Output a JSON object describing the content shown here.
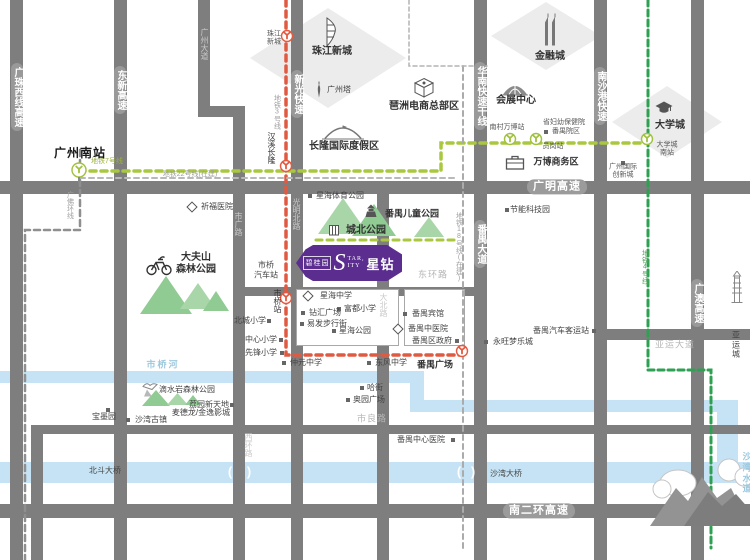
{
  "map": {
    "logo": {
      "brand": "碧桂园",
      "s": "S",
      "tar": "TAR,",
      "ity": "ITY",
      "name": "星钻"
    },
    "colors": {
      "road": "#7e7e7e",
      "river": "#c5e3f4",
      "purple": "#5b2d8e",
      "line3": "#df5a41",
      "line7": "#a9c83f",
      "line4": "#2ea052",
      "dashedGray": "#ababab",
      "parkGreen": "#8fcb92"
    },
    "areas": [
      {
        "name": "zhujiang-new-town",
        "x": 250,
        "y": 8,
        "w": 156,
        "h": 100
      },
      {
        "name": "financial-city",
        "x": 491,
        "y": 2,
        "w": 110,
        "h": 68
      },
      {
        "name": "university-town",
        "x": 612,
        "y": 86,
        "w": 110,
        "h": 72
      }
    ],
    "rivers": [
      {
        "x": 0,
        "y": 371,
        "w": 424,
        "h": 12
      },
      {
        "x": 410,
        "y": 371,
        "w": 14,
        "h": 41
      },
      {
        "x": 410,
        "y": 400,
        "w": 307,
        "h": 12
      },
      {
        "x": 717,
        "y": 400,
        "w": 21,
        "h": 83
      },
      {
        "x": 0,
        "y": 462,
        "w": 750,
        "h": 21
      }
    ],
    "roads": [
      {
        "x": 10,
        "y": 0,
        "w": 13,
        "h": 560
      },
      {
        "x": 114,
        "y": 0,
        "w": 13,
        "h": 560
      },
      {
        "x": 198,
        "y": 0,
        "w": 12,
        "h": 114
      },
      {
        "x": 198,
        "y": 106,
        "w": 47,
        "h": 11
      },
      {
        "x": 233,
        "y": 106,
        "w": 12,
        "h": 454
      },
      {
        "x": 291,
        "y": 0,
        "w": 12,
        "h": 560
      },
      {
        "x": 474,
        "y": 0,
        "w": 13,
        "h": 560
      },
      {
        "x": 594,
        "y": 0,
        "w": 13,
        "h": 560
      },
      {
        "x": 691,
        "y": 0,
        "w": 13,
        "h": 560
      },
      {
        "x": 377,
        "y": 187,
        "w": 12,
        "h": 373
      },
      {
        "x": 31,
        "y": 425,
        "w": 12,
        "h": 135
      },
      {
        "x": 0,
        "y": 181,
        "w": 750,
        "h": 13
      },
      {
        "x": 0,
        "y": 504,
        "w": 750,
        "h": 14
      },
      {
        "x": 31,
        "y": 425,
        "w": 719,
        "h": 9
      },
      {
        "x": 233,
        "y": 287,
        "w": 254,
        "h": 9
      },
      {
        "x": 597,
        "y": 329,
        "w": 153,
        "h": 11
      }
    ],
    "blocks": [
      {
        "x": 296,
        "y": 289,
        "w": 103,
        "h": 57
      },
      {
        "x": 404,
        "y": 289,
        "w": 61,
        "h": 57
      }
    ],
    "metro_lines": [
      {
        "name": "line-3",
        "c": "#df5a41",
        "w": 3.5,
        "dash": "6 5",
        "pts": "286,0 286,355 460,355"
      },
      {
        "name": "line-7",
        "c": "#a9c83f",
        "w": 3.5,
        "dash": "6 5",
        "pts": "79,171 441,171 441,143 648,143"
      },
      {
        "name": "line-22-uc",
        "c": "#b9b9b9",
        "w": 2,
        "dash": "5 4",
        "pts": "80,178 458,178"
      },
      {
        "name": "line-4",
        "c": "#2ea052",
        "w": 3,
        "dash": "6 4",
        "pts": "648,0 648,370 711,370 711,548"
      },
      {
        "name": "line-18-uc",
        "c": "#ababab",
        "w": 2,
        "dash": "5 4",
        "pts": "463,66 463,548"
      },
      {
        "name": "pazhou-boundary",
        "c": "#b3b3b3",
        "w": 1.5,
        "dash": "4 3",
        "pts": "409,0 409,66 488,66"
      },
      {
        "name": "intercity-rail",
        "c": "#8f8f8f",
        "w": 2.5,
        "dash": "6 4",
        "pts": "80,150 80,230 25,230 25,560"
      },
      {
        "name": "line-7-east-seg",
        "c": "#a9c83f",
        "w": 3,
        "dash": "6 5",
        "pts": "316,240 459,240"
      }
    ],
    "stations": [
      {
        "name": "珠江新城",
        "x": 287,
        "y": 39,
        "c": "#e4593f"
      },
      {
        "name": "汉溪长隆",
        "x": 286,
        "y": 169,
        "c": "#e4593f"
      },
      {
        "name": "市桥",
        "x": 286,
        "y": 301,
        "c": "#e4593f"
      },
      {
        "name": "番禺广场",
        "x": 462,
        "y": 354,
        "c": "#e4593f"
      },
      {
        "name": "广州南站",
        "x": 79,
        "y": 170,
        "c": "#9fc13d",
        "stem": 1
      },
      {
        "name": "南村万博",
        "x": 510,
        "y": 142,
        "c": "#9fc13d"
      },
      {
        "name": "员岗",
        "x": 536,
        "y": 142,
        "c": "#9fc13d"
      },
      {
        "name": "大学城南",
        "x": 647,
        "y": 142,
        "c": "#9fc13d"
      }
    ],
    "mountains": [
      {
        "x": 318,
        "y": 198,
        "w": 50,
        "h": 36,
        "c": "#a9d6a9"
      },
      {
        "x": 352,
        "y": 204,
        "w": 44,
        "h": 32,
        "c": "#8fcb92"
      },
      {
        "x": 414,
        "y": 217,
        "w": 30,
        "h": 20,
        "c": "#a9d6a9"
      },
      {
        "x": 140,
        "y": 276,
        "w": 52,
        "h": 38,
        "c": "#8fcb92"
      },
      {
        "x": 180,
        "y": 283,
        "w": 36,
        "h": 26,
        "c": "#a9d6a9"
      },
      {
        "x": 203,
        "y": 291,
        "w": 26,
        "h": 20,
        "c": "#8fcb92"
      },
      {
        "x": 142,
        "y": 390,
        "w": 28,
        "h": 16,
        "c": "#8fcb92"
      },
      {
        "x": 167,
        "y": 393,
        "w": 21,
        "h": 12,
        "c": "#a9d6a9"
      },
      {
        "x": 185,
        "y": 395,
        "w": 16,
        "h": 10,
        "c": "#8fcb92"
      }
    ],
    "icons": [
      {
        "k": "sq",
        "x": 310,
        "y": 196
      },
      {
        "k": "pagoda",
        "x": 371,
        "y": 211
      },
      {
        "k": "bldg",
        "x": 334,
        "y": 230
      },
      {
        "k": "dia",
        "x": 192,
        "y": 207
      },
      {
        "k": "sq",
        "x": 269,
        "y": 321
      },
      {
        "k": "sq",
        "x": 281,
        "y": 340
      },
      {
        "k": "sq",
        "x": 282,
        "y": 353
      },
      {
        "k": "dia",
        "x": 308,
        "y": 296
      },
      {
        "k": "sq",
        "x": 303,
        "y": 313
      },
      {
        "k": "sq",
        "x": 339,
        "y": 309
      },
      {
        "k": "sq",
        "x": 302,
        "y": 324
      },
      {
        "k": "sq",
        "x": 334,
        "y": 331
      },
      {
        "k": "sq",
        "x": 405,
        "y": 314
      },
      {
        "k": "dia",
        "x": 398,
        "y": 329
      },
      {
        "k": "sq",
        "x": 457,
        "y": 341
      },
      {
        "k": "sq",
        "x": 284,
        "y": 363
      },
      {
        "k": "sq",
        "x": 369,
        "y": 363
      },
      {
        "k": "sq",
        "x": 362,
        "y": 388
      },
      {
        "k": "sq",
        "x": 348,
        "y": 400
      },
      {
        "k": "sq",
        "x": 453,
        "y": 440
      },
      {
        "k": "sq",
        "x": 486,
        "y": 342
      },
      {
        "k": "sq",
        "x": 594,
        "y": 331
      },
      {
        "k": "sq",
        "x": 507,
        "y": 210
      },
      {
        "k": "sq",
        "x": 546,
        "y": 132
      },
      {
        "k": "sq",
        "x": 623,
        "y": 163
      },
      {
        "k": "sq",
        "x": 232,
        "y": 405
      },
      {
        "k": "sq",
        "x": 108,
        "y": 410
      },
      {
        "k": "sq",
        "x": 128,
        "y": 420
      },
      {
        "k": "brief",
        "x": 515,
        "y": 162
      },
      {
        "k": "dome",
        "x": 515,
        "y": 89
      },
      {
        "k": "cube",
        "x": 424,
        "y": 88
      },
      {
        "k": "tent",
        "x": 343,
        "y": 133
      },
      {
        "k": "tower",
        "x": 319,
        "y": 90
      },
      {
        "k": "twin",
        "x": 550,
        "y": 30
      },
      {
        "k": "curved",
        "x": 331,
        "y": 32
      },
      {
        "k": "cap",
        "x": 664,
        "y": 108
      },
      {
        "k": "bike",
        "x": 159,
        "y": 265
      },
      {
        "k": "bird",
        "x": 150,
        "y": 389
      },
      {
        "k": "pag2",
        "x": 737,
        "y": 287
      }
    ],
    "labels": [
      {
        "t": "广珠西线高速",
        "x": 17,
        "y": 97,
        "c": "hwy-v v"
      },
      {
        "t": "东新高速",
        "x": 120,
        "y": 90,
        "c": "hwy-v v"
      },
      {
        "t": "新光快速",
        "x": 297,
        "y": 94,
        "c": "hwy-v v"
      },
      {
        "t": "华南快速干线",
        "x": 480,
        "y": 96,
        "c": "hwy-v v"
      },
      {
        "t": "南沙港快速",
        "x": 600,
        "y": 96,
        "c": "hwy-v v"
      },
      {
        "t": "番禺大道",
        "x": 480,
        "y": 244,
        "c": "hwy-v v"
      },
      {
        "t": "广澳高速",
        "x": 697,
        "y": 303,
        "c": "hwy-v v"
      },
      {
        "t": "广州大道",
        "x": 204,
        "y": 44,
        "c": "onroad-v v"
      },
      {
        "t": "光明北路",
        "x": 296,
        "y": 214,
        "c": "onroad-v v"
      },
      {
        "t": "市广路",
        "x": 238,
        "y": 224,
        "c": "onroad-v v"
      },
      {
        "t": "西环路",
        "x": 248,
        "y": 445,
        "c": "onroad-v v"
      },
      {
        "t": "大北路",
        "x": 383,
        "y": 305,
        "c": "onroad-v v"
      },
      {
        "t": "广明高速",
        "x": 557,
        "y": 187,
        "c": "hwy-h"
      },
      {
        "t": "南二环高速",
        "x": 539,
        "y": 511,
        "c": "hwy-h"
      },
      {
        "t": "东环路",
        "x": 433,
        "y": 275,
        "c": "st-gray"
      },
      {
        "t": "市良路",
        "x": 372,
        "y": 419,
        "c": "st-gray"
      },
      {
        "t": "亚运大道",
        "x": 675,
        "y": 345,
        "c": "st-gray"
      },
      {
        "t": "市桥河",
        "x": 163,
        "y": 365,
        "c": "river-t"
      },
      {
        "t": "沙湾水道",
        "x": 748,
        "y": 473,
        "c": "river-t"
      },
      {
        "t": "地铁7号线",
        "x": 107,
        "y": 162,
        "c": "m-green"
      },
      {
        "t": "地铁22号线(在建)",
        "x": 190,
        "y": 175,
        "c": "m-gray"
      },
      {
        "t": "地铁3号线",
        "x": 277,
        "y": 112,
        "c": "m-gray-v v"
      },
      {
        "t": "地铁4号线",
        "x": 645,
        "y": 267,
        "c": "m-green-v v"
      },
      {
        "t": "地铁18号线(在建)",
        "x": 459,
        "y": 247,
        "c": "m-gray-v v"
      },
      {
        "t": "广佛环线",
        "x": 70,
        "y": 205,
        "c": "m-gray-v v"
      },
      {
        "t": "广州南站",
        "x": 80,
        "y": 153,
        "c": "big-station"
      },
      {
        "t": "珠江\n新城",
        "x": 274,
        "y": 39,
        "c": "tiny"
      },
      {
        "t": "汉溪长隆",
        "x": 271,
        "y": 148,
        "c": "poi-v v"
      },
      {
        "t": "市桥站",
        "x": 277,
        "y": 301,
        "c": "poi-v v"
      },
      {
        "t": "番禺广场",
        "x": 435,
        "y": 365,
        "c": "poi-b"
      },
      {
        "t": "南村万博站",
        "x": 507,
        "y": 128,
        "c": "tiny"
      },
      {
        "t": "员岗站",
        "x": 553,
        "y": 147,
        "c": "tiny"
      },
      {
        "t": "大学城\n南站",
        "x": 667,
        "y": 150,
        "c": "tiny"
      },
      {
        "t": "星海体育公园",
        "x": 340,
        "y": 196,
        "c": "poi"
      },
      {
        "t": "番禺儿童公园",
        "x": 412,
        "y": 214,
        "c": "poi-b"
      },
      {
        "t": "城北公园",
        "x": 366,
        "y": 231,
        "c": "poi-B"
      },
      {
        "t": "祈福医院",
        "x": 217,
        "y": 207,
        "c": "poi"
      },
      {
        "t": "市桥\n汽车站",
        "x": 266,
        "y": 270,
        "c": "poi"
      },
      {
        "t": "北城小学",
        "x": 250,
        "y": 321,
        "c": "poi"
      },
      {
        "t": "中心小学",
        "x": 261,
        "y": 340,
        "c": "poi"
      },
      {
        "t": "先锋小学",
        "x": 261,
        "y": 353,
        "c": "poi"
      },
      {
        "t": "星海中学",
        "x": 336,
        "y": 296,
        "c": "poi"
      },
      {
        "t": "钻汇广场",
        "x": 325,
        "y": 313,
        "c": "poi"
      },
      {
        "t": "富都小学",
        "x": 360,
        "y": 309,
        "c": "poi"
      },
      {
        "t": "易发步行街",
        "x": 327,
        "y": 324,
        "c": "poi"
      },
      {
        "t": "星海公园",
        "x": 355,
        "y": 331,
        "c": "poi"
      },
      {
        "t": "番禺宾馆",
        "x": 428,
        "y": 314,
        "c": "poi"
      },
      {
        "t": "番禺中医院",
        "x": 428,
        "y": 329,
        "c": "poi"
      },
      {
        "t": "番禺区政府",
        "x": 432,
        "y": 341,
        "c": "poi"
      },
      {
        "t": "仲元中学",
        "x": 306,
        "y": 363,
        "c": "poi"
      },
      {
        "t": "东风中学",
        "x": 391,
        "y": 363,
        "c": "poi"
      },
      {
        "t": "哈街",
        "x": 375,
        "y": 388,
        "c": "poi"
      },
      {
        "t": "奥园广场",
        "x": 369,
        "y": 400,
        "c": "poi"
      },
      {
        "t": "番禺中心医院",
        "x": 421,
        "y": 440,
        "c": "poi"
      },
      {
        "t": "永旺梦乐城",
        "x": 513,
        "y": 342,
        "c": "poi"
      },
      {
        "t": "番禺汽车客运站",
        "x": 561,
        "y": 331,
        "c": "poi"
      },
      {
        "t": "节能科技园",
        "x": 530,
        "y": 210,
        "c": "poi"
      },
      {
        "t": "省妇幼保健院",
        "x": 564,
        "y": 123,
        "c": "tiny"
      },
      {
        "t": "番禺院区",
        "x": 566,
        "y": 132,
        "c": "tiny"
      },
      {
        "t": "广州国际\n创新城",
        "x": 623,
        "y": 172,
        "c": "tiny"
      },
      {
        "t": "万博商务区",
        "x": 556,
        "y": 162,
        "c": "poi-b"
      },
      {
        "t": "会展中心",
        "x": 516,
        "y": 101,
        "c": "poi-B"
      },
      {
        "t": "琶洲电商总部区",
        "x": 424,
        "y": 107,
        "c": "poi-B"
      },
      {
        "t": "长隆国际度假区",
        "x": 344,
        "y": 147,
        "c": "poi-B"
      },
      {
        "t": "广州塔",
        "x": 339,
        "y": 90,
        "c": "poi"
      },
      {
        "t": "金融城",
        "x": 550,
        "y": 57,
        "c": "poi-B"
      },
      {
        "t": "珠江新城",
        "x": 332,
        "y": 52,
        "c": "poi-B"
      },
      {
        "t": "大学城",
        "x": 670,
        "y": 126,
        "c": "poi-B"
      },
      {
        "t": "大夫山\n森林公园",
        "x": 196,
        "y": 264,
        "c": "poi-B"
      },
      {
        "t": "滴水岩森林公园",
        "x": 187,
        "y": 390,
        "c": "poi"
      },
      {
        "t": "荔园新天地",
        "x": 209,
        "y": 405,
        "c": "poi"
      },
      {
        "t": "麦德龙/金逸影城",
        "x": 201,
        "y": 413,
        "c": "poi"
      },
      {
        "t": "宝墨园",
        "x": 104,
        "y": 417,
        "c": "poi"
      },
      {
        "t": "沙湾古镇",
        "x": 151,
        "y": 420,
        "c": "poi"
      },
      {
        "t": "北斗大桥",
        "x": 105,
        "y": 471,
        "c": "poi"
      },
      {
        "t": "沙湾大桥",
        "x": 506,
        "y": 474,
        "c": "poi"
      },
      {
        "t": "亚运城",
        "x": 736,
        "y": 345,
        "c": "poi"
      },
      {
        "t": "(",
        "x": 230,
        "y": 472,
        "c": "br"
      },
      {
        "t": ")",
        "x": 249,
        "y": 472,
        "c": "br"
      },
      {
        "t": "(",
        "x": 459,
        "y": 472,
        "c": "br"
      },
      {
        "t": ")",
        "x": 473,
        "y": 472,
        "c": "br"
      }
    ]
  }
}
